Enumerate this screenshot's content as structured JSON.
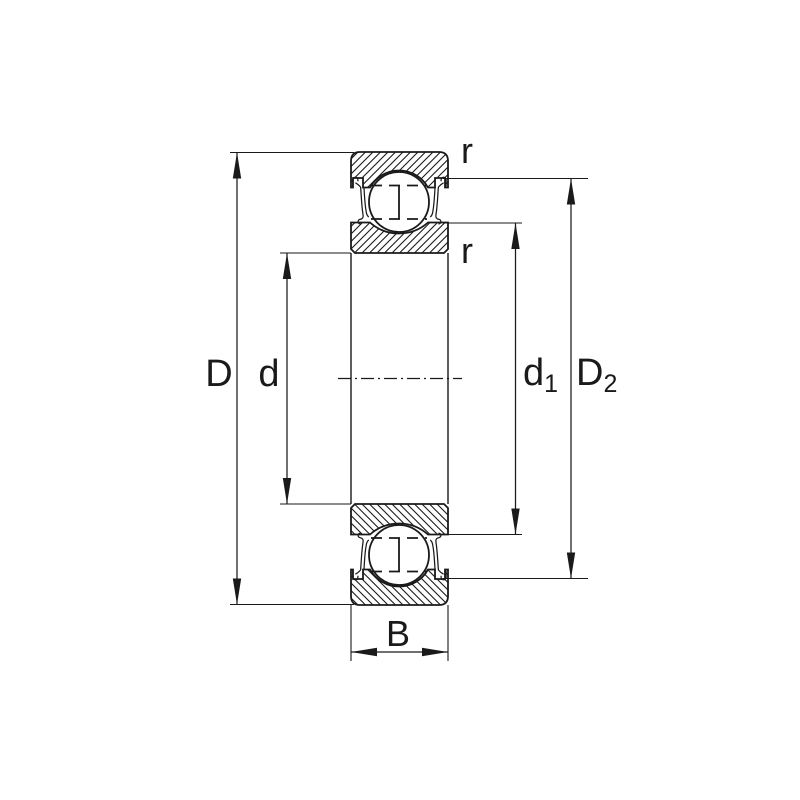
{
  "diagram": {
    "labels": {
      "outer_diameter": "D",
      "bore_diameter": "d",
      "d1_main": "d",
      "d1_sub": "1",
      "d2_main": "D",
      "d2_sub": "2",
      "width": "B",
      "r_outer": "r",
      "r_inner": "r"
    },
    "colors": {
      "line": "#1a1a1a",
      "background": "#ffffff"
    }
  }
}
